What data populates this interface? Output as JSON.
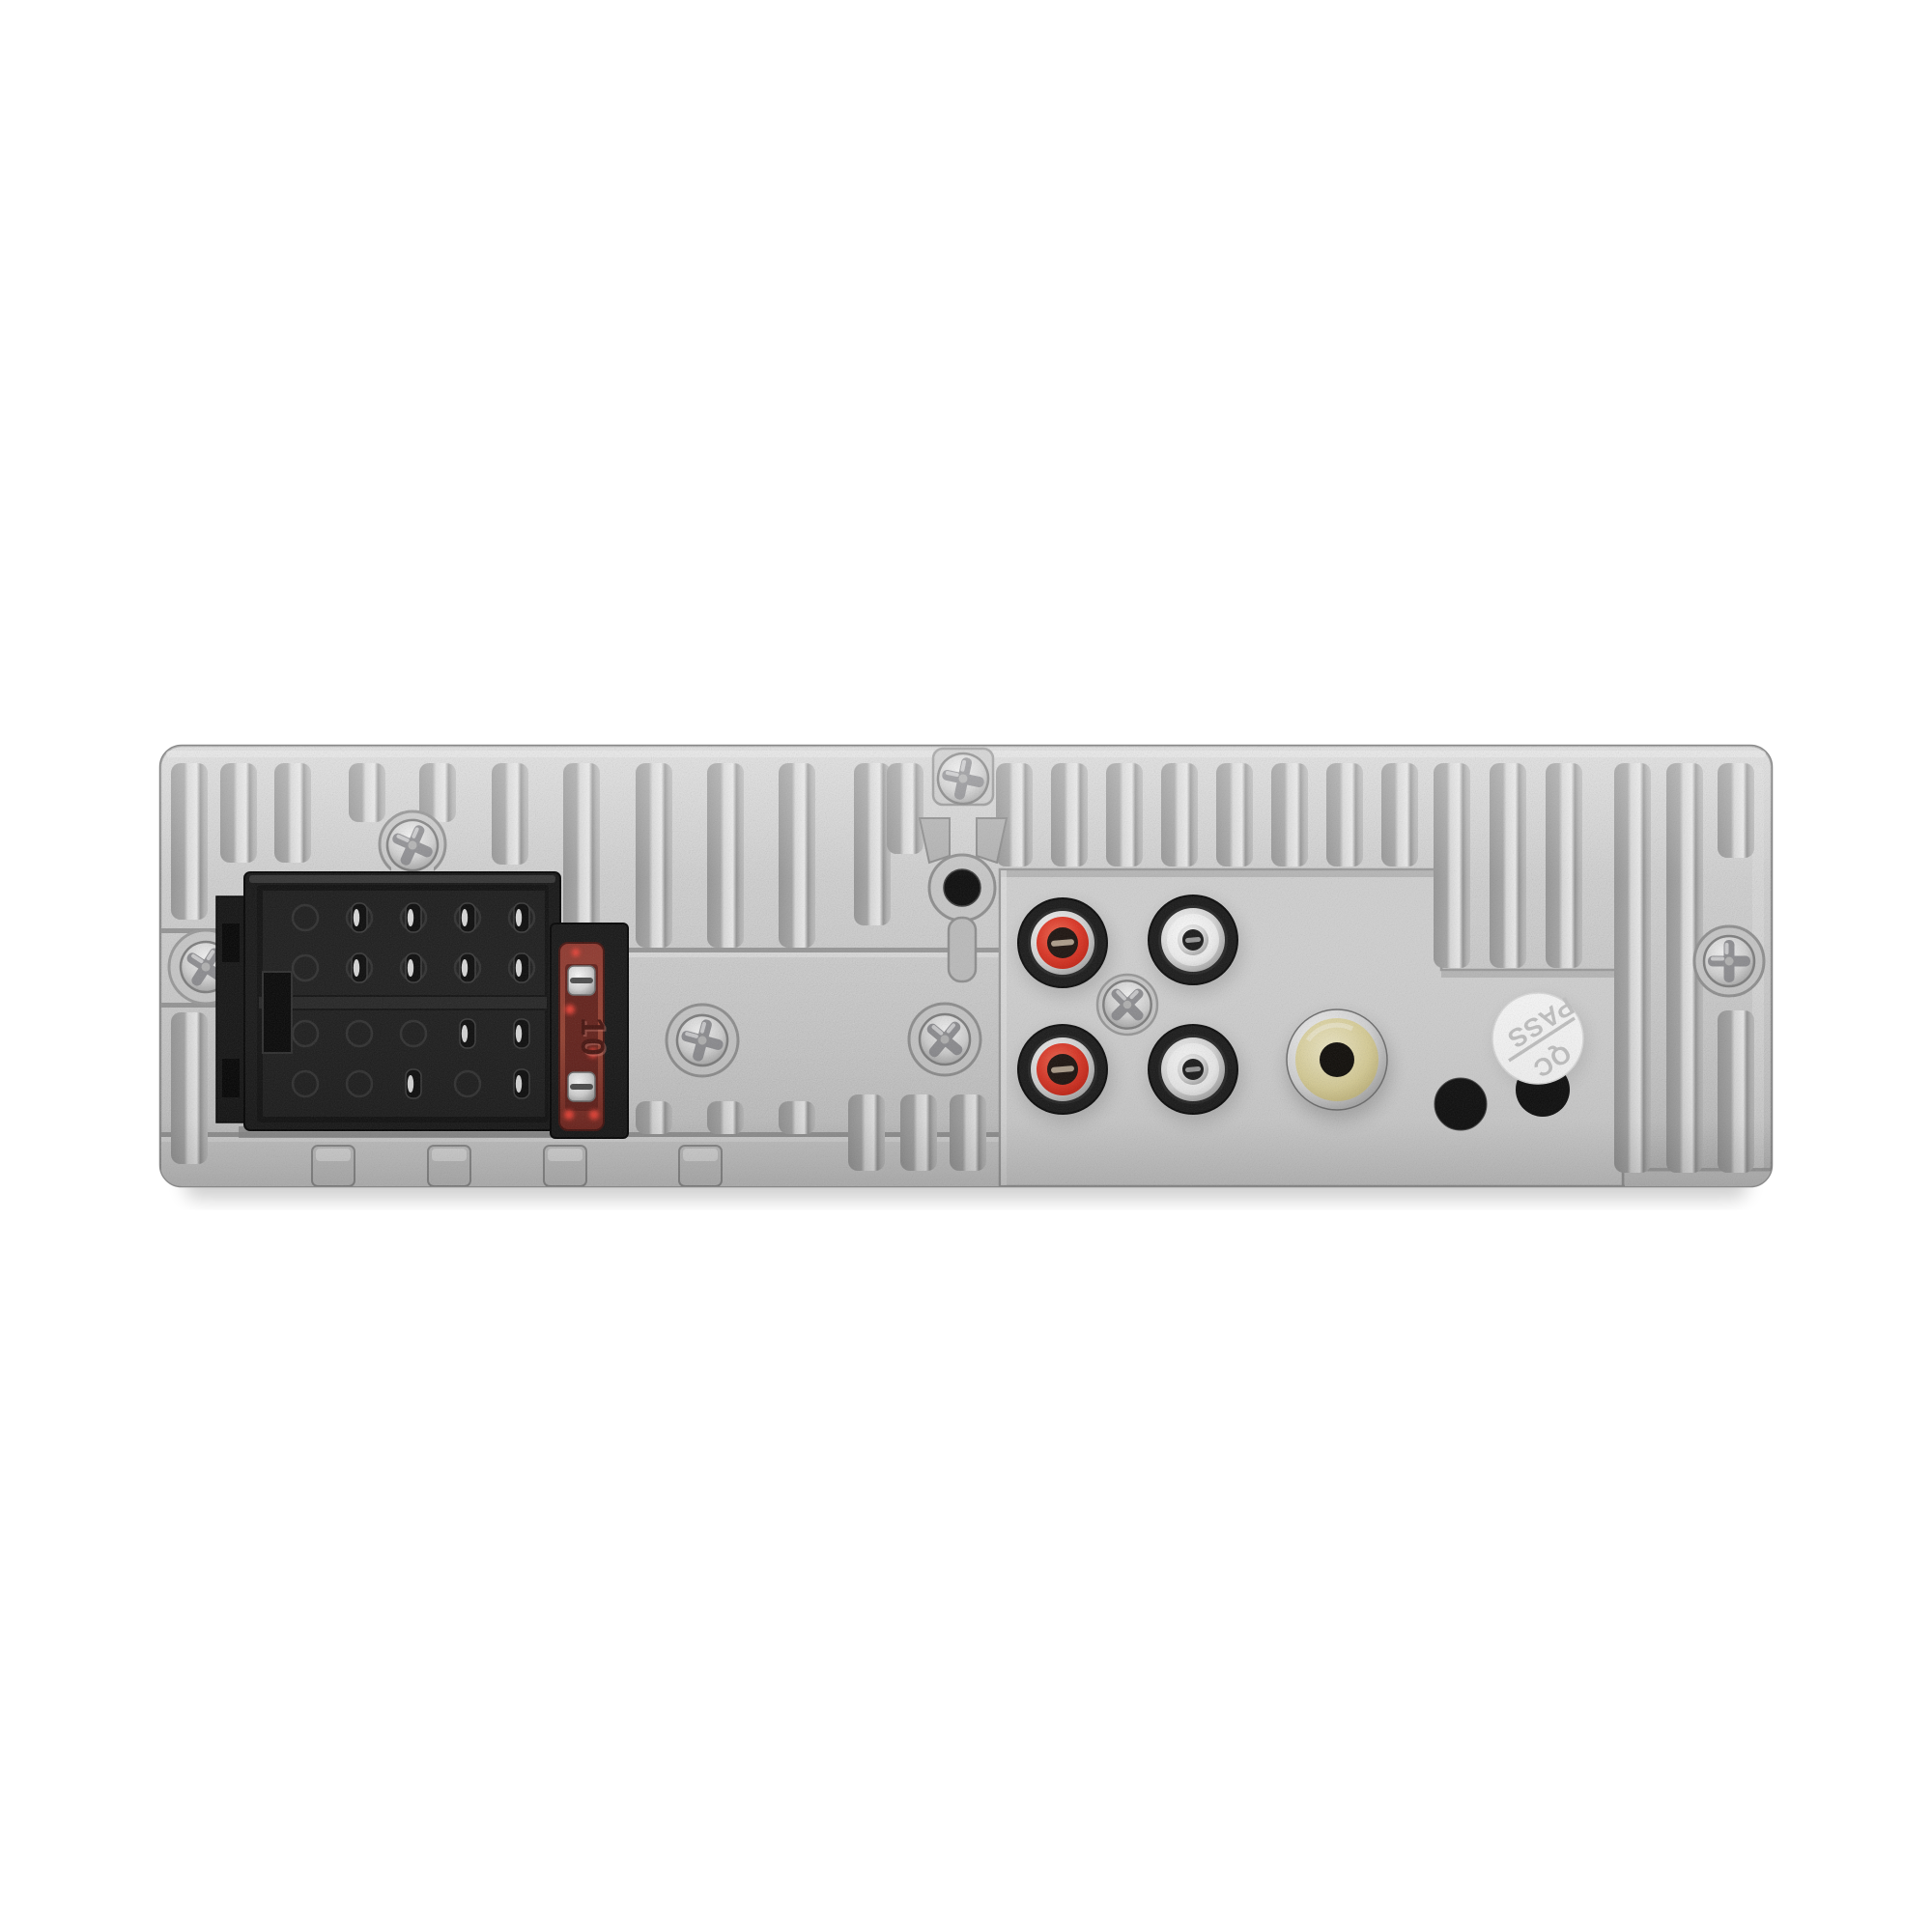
{
  "meta": {
    "image_type": "product photo",
    "alt": "Rear panel of a single-DIN car stereo head unit: cast aluminum heatsink with fins, ISO harness connector, blade fuse, RCA jacks and QC sticker on white background"
  },
  "texts": {
    "fuse_rating": "10",
    "sticker_word_top": "PASS",
    "sticker_word_bottom": "QC"
  },
  "visible_components": [
    "cast aluminum heatsink rear panel with vertical fins",
    "ISO harness connector - power block with 8 pins",
    "ISO harness connector - speaker block with 4 pins",
    "red blade fuse (10) in black holder",
    "phillips screws (left, top, above connector, two middle, right, between RCA jacks)",
    "keyhole mounting hole",
    "2 red RCA jacks",
    "2 white RCA jacks",
    "1 yellow RCA jack",
    "round cable pass-through hole",
    "round QC PASS sticker partially covering a second hole"
  ],
  "colors": {
    "background": "#ffffff",
    "chassis": "#c8c8c8",
    "chassis_highlight": "#e9e9e9",
    "groove": "#9a9a9a",
    "connector_black": "#141414",
    "fuse_body": "#81281f",
    "fuse_glow": "#ff4538",
    "fuse_text": "#45100b",
    "rca_red": "#d8291a",
    "rca_white": "#f0f0f0",
    "metal_silver": "#cfcfcf",
    "video_yellow": "#d8cd8f",
    "hole_black": "#0a0a0a",
    "sticker_white": "#fbfbfb",
    "sticker_text": "#c4c4c4"
  }
}
